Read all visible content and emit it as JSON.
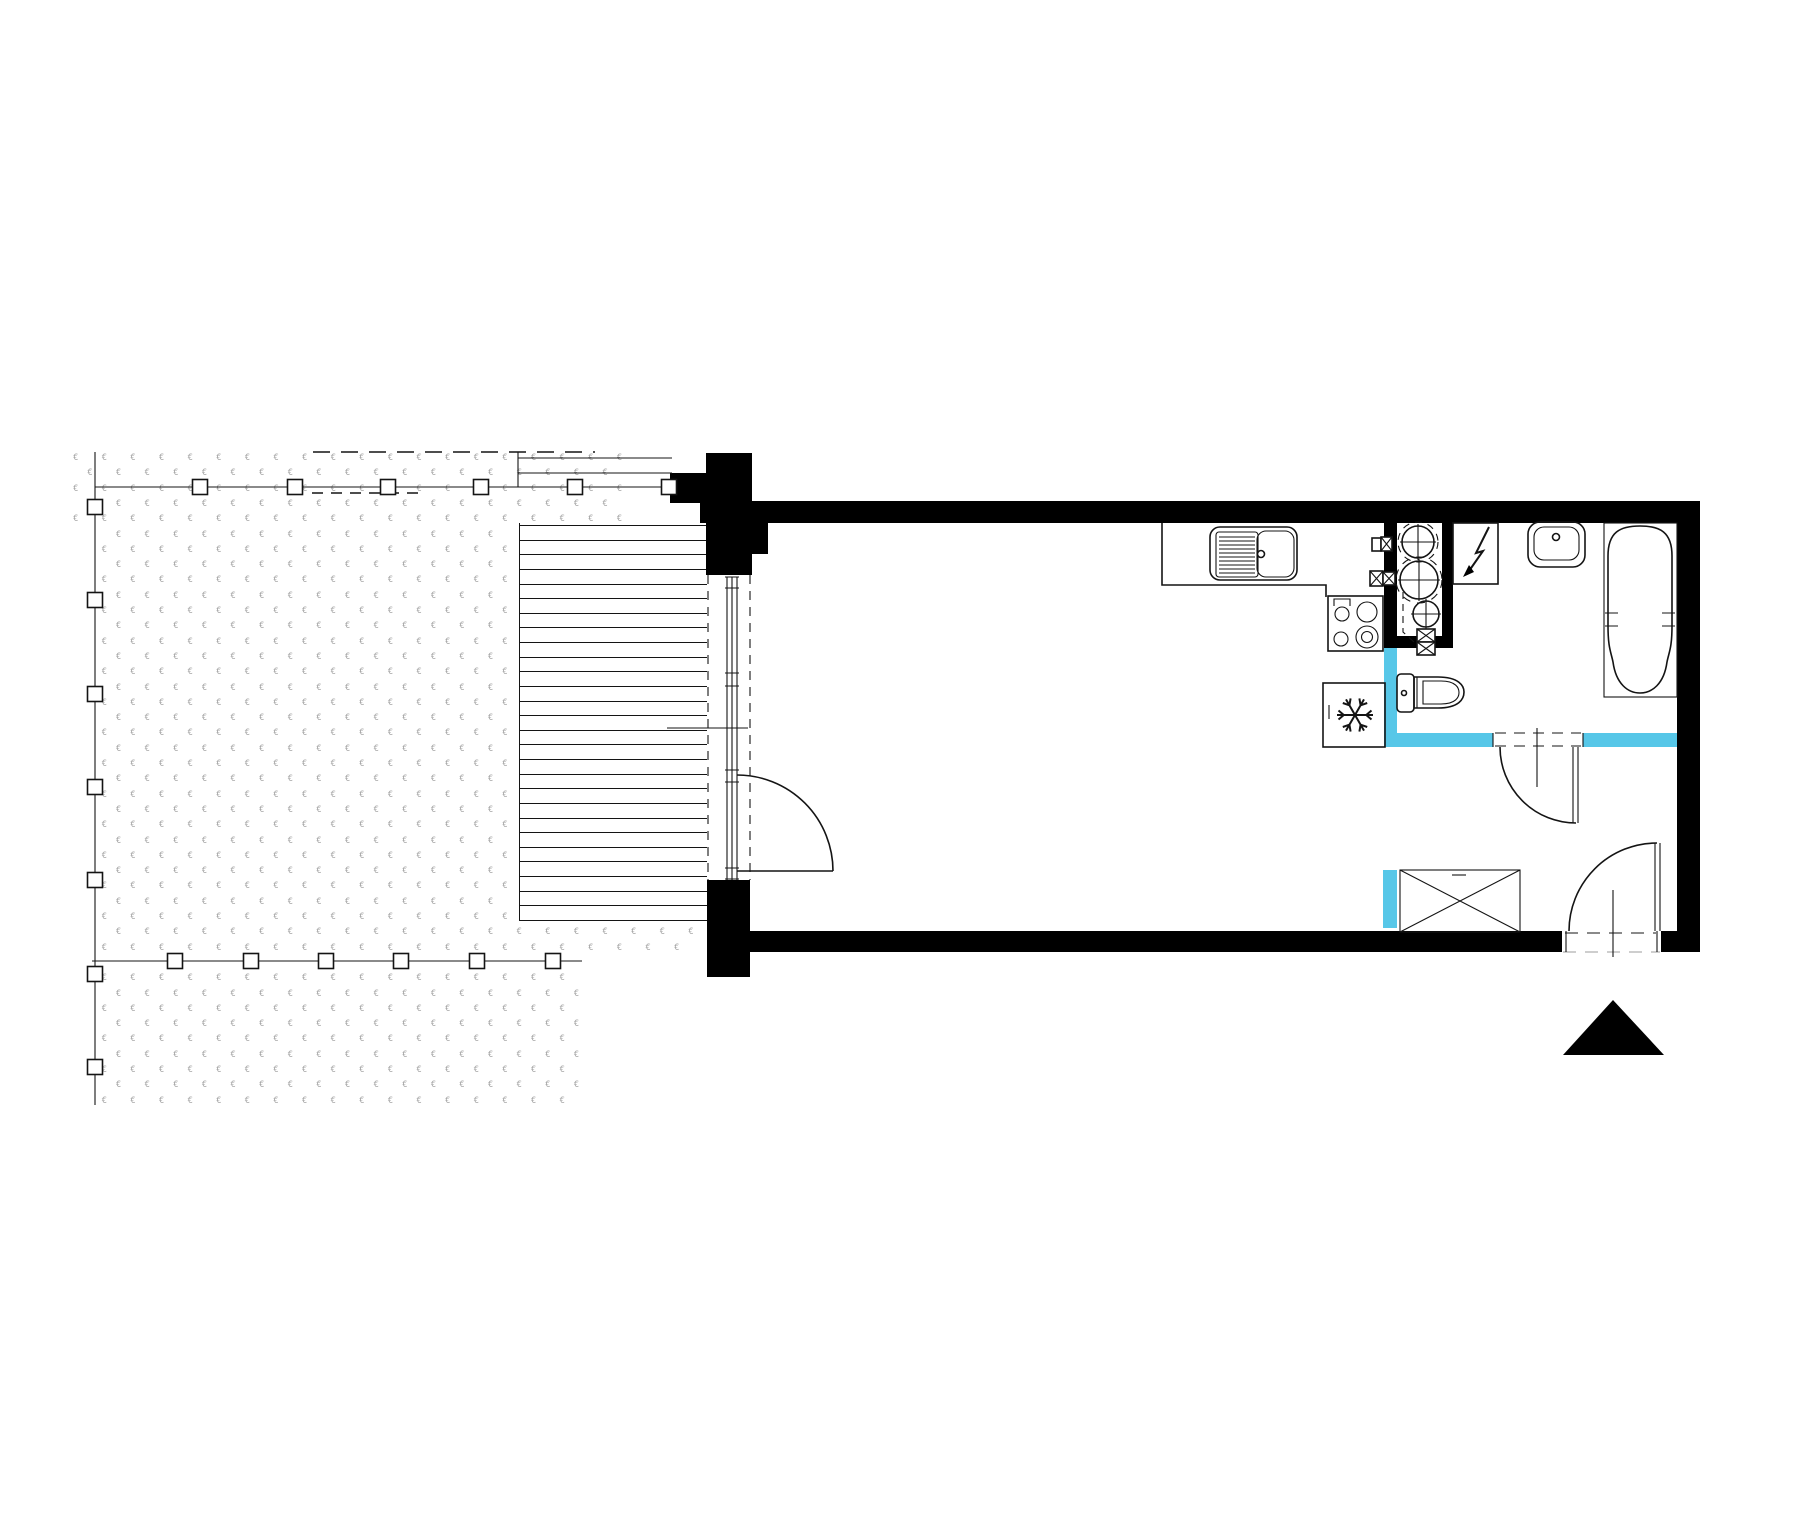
{
  "document": {
    "kind": "architectural-floor-plan",
    "description": "studio apartment plan with terrace decking, garden, kitchen corner, bathroom and entrance arrow"
  },
  "colors": {
    "background": "#ffffff",
    "walls": "#000000",
    "lines": "#141414",
    "plumbing_wall_accent": "#57C7E8",
    "grass": "#a6a6a6",
    "light_dash": "#bdbdbd"
  },
  "garden": {
    "tuft_glyph": "€",
    "fence_posts_top": 6,
    "fence_posts_left": 7,
    "fence_posts_bottom": 6,
    "deck_boards": 28
  },
  "rooms": {
    "main_room": "living-kitchen studio room",
    "bathroom": "bathroom with tub",
    "terrace": "decked terrace",
    "garden": "private garden"
  },
  "fixtures": [
    "kitchen counter",
    "kitchen sink with drainer",
    "4-burner cooktop",
    "refrigerator",
    "plumbing riser shaft (3 pipes)",
    "shut-off valves",
    "electrical panel",
    "washbasin",
    "bathtub",
    "toilet",
    "wardrobe",
    "balcony window-door",
    "bathroom door",
    "entrance door",
    "entrance direction triangle"
  ]
}
